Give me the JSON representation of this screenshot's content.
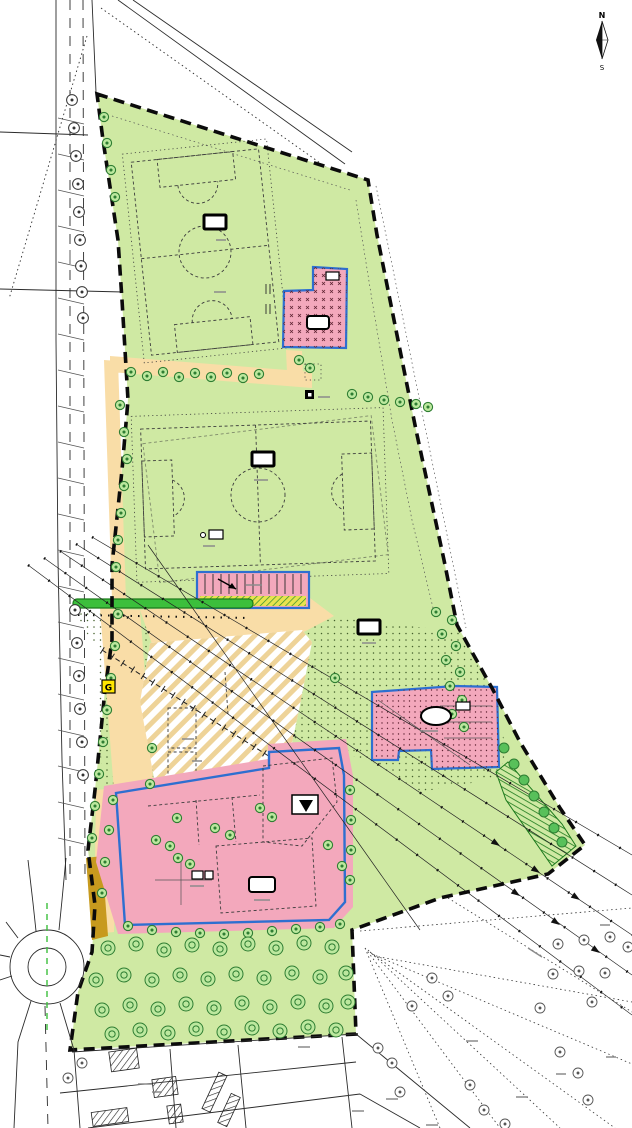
{
  "compass": {
    "north": "N",
    "south": "S"
  },
  "marker_g": "G",
  "colors": {
    "park_green": "#cfe9a3",
    "pink": "#f3a8bc",
    "pink_dot": "#5f2433",
    "blue_outline": "#2e6fd0",
    "path_tan": "#f9dda7",
    "stripe_tan": "#eed398",
    "olive": "#c79a1e",
    "hedge_green": "#3cbf3c",
    "hedge_dark": "#1c7a1c",
    "strip_yellow": "#e8e34f",
    "strip_green": "#2e8b2e",
    "marker_yellow": "#ffe600",
    "tree_fill": "#bce89e",
    "tree_stroke": "#2e7d32",
    "bush_fill": "#58c05a",
    "meadow_dot": "#44602c",
    "line_dark": "#333333",
    "line_gray": "#555555",
    "white": "#ffffff",
    "black": "#111111"
  },
  "trees": {
    "road": [
      [
        72,
        100
      ],
      [
        74,
        128
      ],
      [
        76,
        156
      ],
      [
        78,
        184
      ],
      [
        79,
        212
      ],
      [
        80,
        240
      ],
      [
        81,
        266
      ],
      [
        82,
        292
      ],
      [
        83,
        318
      ],
      [
        75,
        610
      ],
      [
        77,
        643
      ],
      [
        79,
        676
      ],
      [
        80,
        709
      ],
      [
        82,
        742
      ],
      [
        83,
        775
      ]
    ],
    "park": [
      [
        104,
        117
      ],
      [
        107,
        143
      ],
      [
        111,
        170
      ],
      [
        115,
        197
      ],
      [
        131,
        372
      ],
      [
        147,
        376
      ],
      [
        163,
        372
      ],
      [
        179,
        377
      ],
      [
        195,
        373
      ],
      [
        211,
        377
      ],
      [
        227,
        373
      ],
      [
        243,
        378
      ],
      [
        259,
        374
      ],
      [
        299,
        360
      ],
      [
        310,
        368
      ],
      [
        352,
        394
      ],
      [
        368,
        397
      ],
      [
        384,
        400
      ],
      [
        400,
        402
      ],
      [
        416,
        404
      ],
      [
        428,
        407
      ],
      [
        120,
        405
      ],
      [
        124,
        432
      ],
      [
        127,
        459
      ],
      [
        124,
        486
      ],
      [
        121,
        513
      ],
      [
        118,
        540
      ],
      [
        116,
        567
      ],
      [
        118,
        614
      ],
      [
        115,
        646
      ],
      [
        111,
        678
      ],
      [
        107,
        710
      ],
      [
        103,
        742
      ],
      [
        99,
        774
      ],
      [
        95,
        806
      ],
      [
        92,
        838
      ],
      [
        436,
        612
      ],
      [
        452,
        620
      ],
      [
        442,
        634
      ],
      [
        456,
        646
      ],
      [
        446,
        660
      ],
      [
        460,
        672
      ],
      [
        450,
        686
      ],
      [
        462,
        700
      ],
      [
        452,
        714
      ],
      [
        464,
        727
      ],
      [
        335,
        678
      ],
      [
        152,
        748
      ],
      [
        150,
        784
      ]
    ],
    "plot": [
      [
        177,
        818
      ],
      [
        156,
        840
      ],
      [
        170,
        846
      ],
      [
        178,
        858
      ],
      [
        190,
        864
      ],
      [
        215,
        828
      ],
      [
        230,
        835
      ],
      [
        260,
        808
      ],
      [
        272,
        817
      ],
      [
        328,
        845
      ],
      [
        342,
        866
      ],
      [
        128,
        926
      ],
      [
        152,
        930
      ],
      [
        176,
        932
      ],
      [
        200,
        933
      ],
      [
        224,
        934
      ],
      [
        248,
        933
      ],
      [
        272,
        931
      ],
      [
        296,
        929
      ],
      [
        320,
        927
      ],
      [
        340,
        924
      ],
      [
        113,
        800
      ],
      [
        109,
        830
      ],
      [
        105,
        862
      ],
      [
        102,
        893
      ],
      [
        350,
        790
      ],
      [
        351,
        820
      ],
      [
        351,
        850
      ],
      [
        350,
        880
      ]
    ],
    "orchard": [
      [
        108,
        948
      ],
      [
        136,
        944
      ],
      [
        164,
        950
      ],
      [
        192,
        945
      ],
      [
        220,
        949
      ],
      [
        248,
        944
      ],
      [
        276,
        948
      ],
      [
        304,
        943
      ],
      [
        332,
        947
      ],
      [
        96,
        980
      ],
      [
        124,
        975
      ],
      [
        152,
        980
      ],
      [
        180,
        975
      ],
      [
        208,
        979
      ],
      [
        236,
        974
      ],
      [
        264,
        978
      ],
      [
        292,
        973
      ],
      [
        320,
        977
      ],
      [
        346,
        973
      ],
      [
        102,
        1010
      ],
      [
        130,
        1005
      ],
      [
        158,
        1009
      ],
      [
        186,
        1004
      ],
      [
        214,
        1008
      ],
      [
        242,
        1003
      ],
      [
        270,
        1007
      ],
      [
        298,
        1002
      ],
      [
        326,
        1006
      ],
      [
        348,
        1002
      ],
      [
        112,
        1034
      ],
      [
        140,
        1030
      ],
      [
        168,
        1033
      ],
      [
        196,
        1029
      ],
      [
        224,
        1032
      ],
      [
        252,
        1028
      ],
      [
        280,
        1031
      ],
      [
        308,
        1027
      ],
      [
        336,
        1030
      ]
    ],
    "cadastral": [
      [
        558,
        944
      ],
      [
        584,
        940
      ],
      [
        610,
        937
      ],
      [
        553,
        974
      ],
      [
        579,
        971
      ],
      [
        628,
        947
      ],
      [
        605,
        973
      ],
      [
        540,
        1008
      ],
      [
        592,
        1002
      ],
      [
        432,
        978
      ],
      [
        448,
        996
      ],
      [
        412,
        1006
      ],
      [
        560,
        1052
      ],
      [
        578,
        1073
      ],
      [
        470,
        1085
      ],
      [
        484,
        1110
      ],
      [
        505,
        1124
      ],
      [
        588,
        1100
      ],
      [
        378,
        1048
      ],
      [
        392,
        1063
      ],
      [
        400,
        1092
      ],
      [
        68,
        1078
      ],
      [
        82,
        1063
      ]
    ],
    "bushes": [
      [
        504,
        748
      ],
      [
        514,
        764
      ],
      [
        524,
        780
      ],
      [
        534,
        796
      ],
      [
        544,
        812
      ],
      [
        554,
        828
      ],
      [
        562,
        842
      ]
    ]
  }
}
